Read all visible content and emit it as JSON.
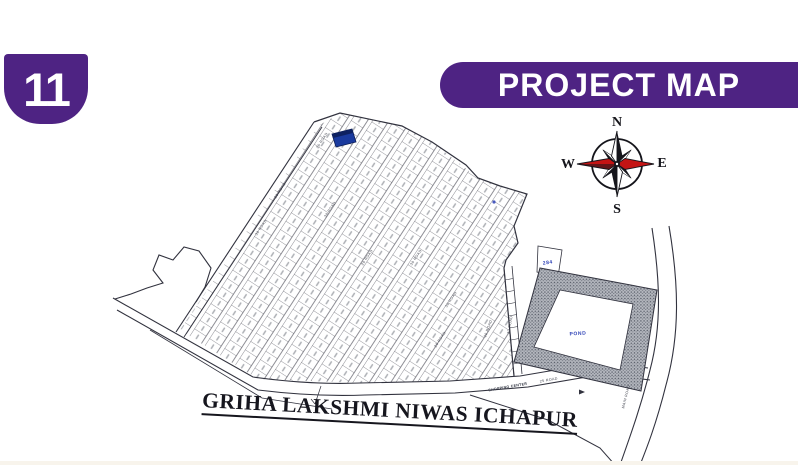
{
  "slide": {
    "number": "11",
    "banner": "PROJECT MAP",
    "title": "GRIHA LAKSHMI NIWAS ICHAPUR"
  },
  "compass": {
    "north": "N",
    "south": "S",
    "east": "E",
    "west": "W"
  },
  "map": {
    "pond_label": "POND",
    "plot_number": "284",
    "shopping_center_label": "SHOPPING CENTER",
    "road_25": "25 ROAD",
    "road_30": "30 ROAD",
    "road_20": "20 ROAD",
    "main_road_label": "MAIN ROAD"
  },
  "colors": {
    "purple": "#4e2383",
    "compass_red": "#c41414",
    "map_ink": "#31323e",
    "map_blue_label": "#2b3fb5",
    "sold_plot_blue": "#1a3a9e"
  }
}
